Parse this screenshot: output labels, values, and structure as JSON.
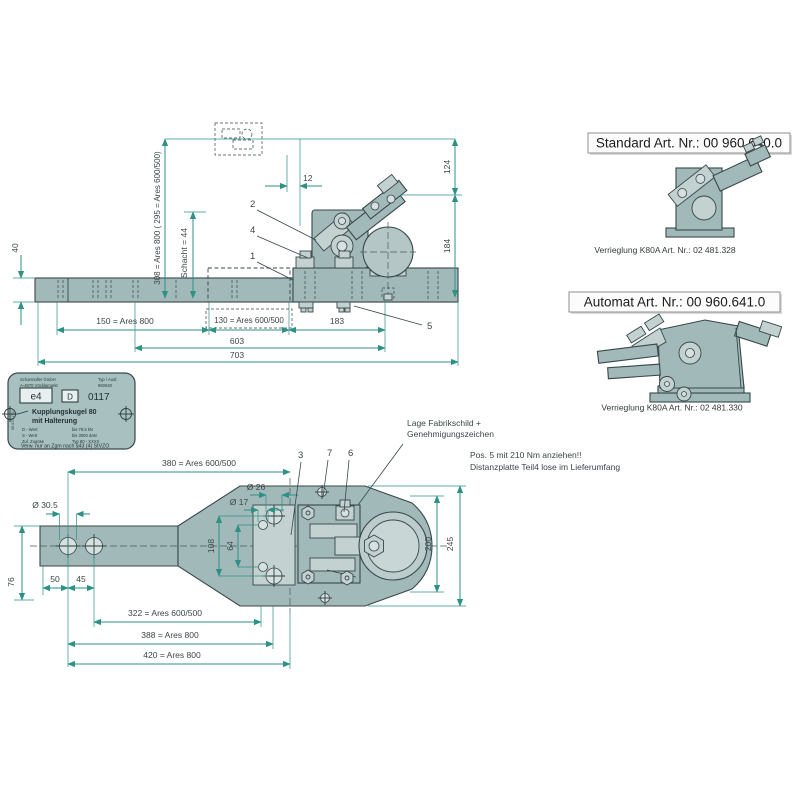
{
  "right_panel": {
    "standard": {
      "title": "Standard Art. Nr.: 00 960.640.0",
      "caption": "Verrieglung K80A Art. Nr.: 02 481.328"
    },
    "automat": {
      "title": "Automat Art. Nr.: 00 960.641.0",
      "caption": "Verrieglung K80A Art. Nr.: 02 481.330"
    }
  },
  "side_view": {
    "dim_40": "40",
    "dim_height": "308 = Ares 800 ( 295 = Ares 600/500)",
    "dim_schacht": "Schacht = 44",
    "dim_12": "12",
    "dim_124": "124",
    "dim_184": "184",
    "dim_150": "150 = Ares 800",
    "dim_130": "130 = Ares 600/500",
    "dim_183": "183",
    "dim_603": "603",
    "dim_703": "703",
    "callout_1": "1",
    "callout_2": "2",
    "callout_4": "4",
    "callout_5": "5"
  },
  "top_view": {
    "dim_380": "380 = Ares 600/500",
    "dim_d26": "Ø 26",
    "dim_d17": "Ø 17",
    "dim_d305": "Ø 30.5",
    "dim_108": "108",
    "dim_64": "64",
    "dim_76": "76",
    "dim_50": "50",
    "dim_45": "45",
    "dim_322": "322 = Ares 600/500",
    "dim_388": "388 = Ares 800",
    "dim_420": "420 = Ares 800",
    "dim_200": "200",
    "dim_245": "245",
    "callout_3": "3",
    "callout_6": "6",
    "callout_7": "7",
    "note_fabrikschild_1": "Lage Fabrikschild +",
    "note_fabrikschild_2": "Genehmigungszeichen",
    "note_pos5_1": "Pos. 5 mit 210 Nm anziehen!!",
    "note_pos5_2": "Distanzplatte Teil4 lose im Lieferumfang"
  },
  "type_plate": {
    "maker_1": "Scharmüller GmbH",
    "maker_2": "A-4870 Vöcklamarkt",
    "maker_3": "Hauptstr. 25",
    "type_label": "Typ / Ausf.",
    "type_value": "960640",
    "approval_e4": "e4",
    "approval_d": "D",
    "approval_nr": "0117",
    "product_1": "Kupplungskugel 80",
    "product_2": "mit Halterung",
    "spec_1_label": "D - Wert",
    "spec_1_value": "bis 78.5 kN",
    "spec_2_label": "S - Wert",
    "spec_2_value": "bis 3000 daN",
    "spec_3_label": "Zul. Zugöse",
    "spec_3_value": "Typ 80 - XXXX",
    "footer": "Verw. nur an Zgm nach §43 (4) StVZO",
    "side_code": "06 675 751"
  }
}
